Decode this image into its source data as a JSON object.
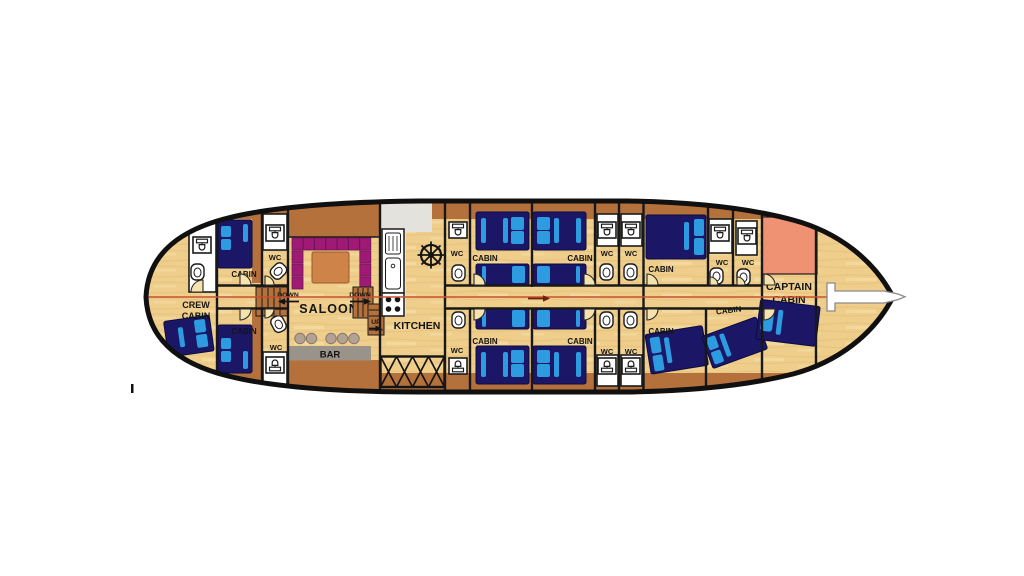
{
  "figure": {
    "type": "boat-deck-floor-plan",
    "view": "top-down lower deck layout of a gulet yacht"
  },
  "labels": {
    "crew_cabin": {
      "line1": "CREW",
      "line2": "CABIN"
    },
    "cabin": "CABIN",
    "wc": "WC",
    "saloon": "SALOON",
    "bar": "BAR",
    "kitchen": "KITCHEN",
    "captain_cabin": {
      "line1": "CAPTAIN",
      "line2": "CABIN"
    },
    "down": "DOWN",
    "up": "UP"
  },
  "colors": {
    "wood": "#EFCE8C",
    "wood_grain": "#DDB56C",
    "wall_brown": "#B5713C",
    "hull_outline": "#101010",
    "bed_navy": "#1B1766",
    "bed_blue": "#2D9BE0",
    "sofa_magenta": "#9E1A75",
    "table_orange": "#CE8348",
    "captain_salmon": "#EF9273",
    "bar_gray": "#99938A",
    "stool_gray": "#B3A294",
    "counter_gray": "#E3E2DC",
    "centerline_red": "#C8502E",
    "wc_white": "#FFFFFF"
  }
}
